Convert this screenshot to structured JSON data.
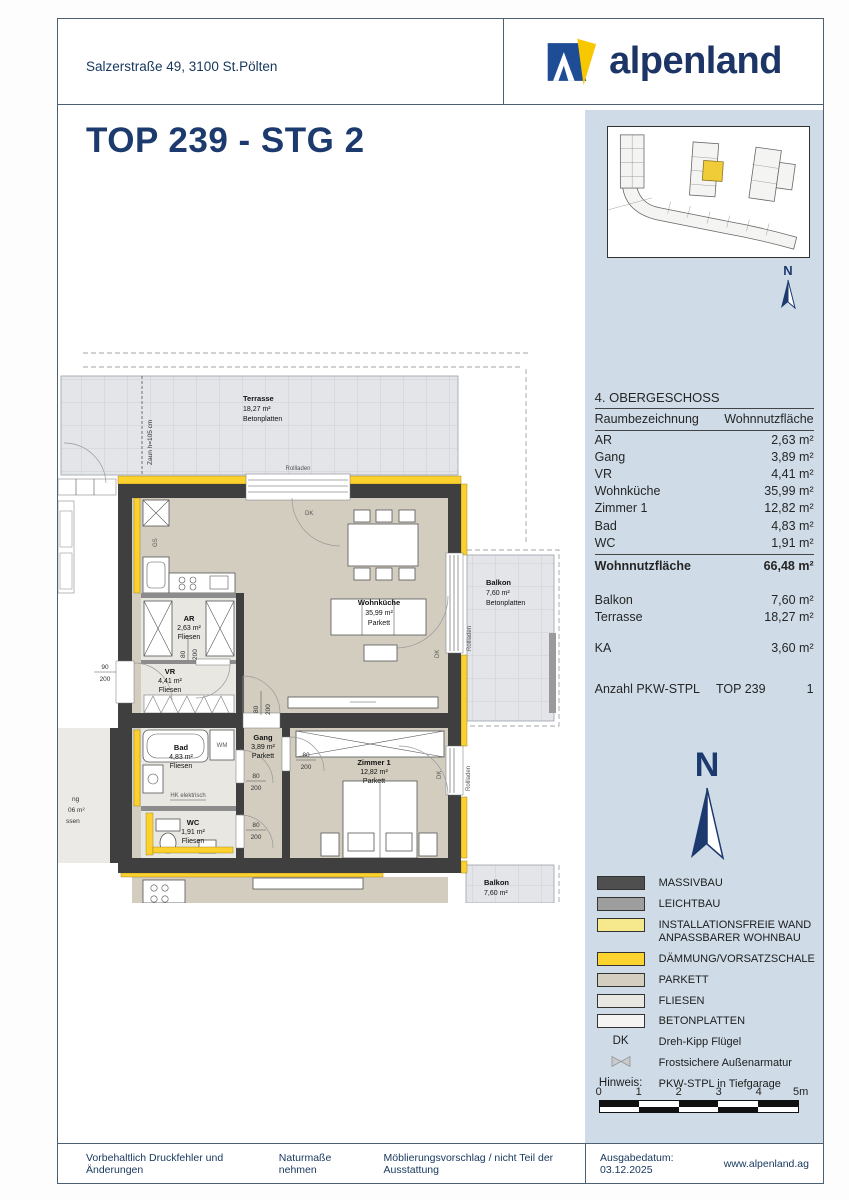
{
  "header": {
    "address": "Salzerstraße 49, 3100 St.Pölten",
    "brand": "alpenland"
  },
  "title": "TOP 239 - STG 2",
  "sidebar": {
    "floor_heading": "4. OBERGESCHOSS",
    "columns": {
      "room": "Raumbezeichnung",
      "area": "Wohnnutzfläche"
    },
    "rows": [
      {
        "label": "AR",
        "value": "2,63 m²"
      },
      {
        "label": "Gang",
        "value": "3,89 m²"
      },
      {
        "label": "VR",
        "value": "4,41 m²"
      },
      {
        "label": "Wohnküche",
        "value": "35,99 m²"
      },
      {
        "label": "Zimmer 1",
        "value": "12,82 m²"
      },
      {
        "label": "Bad",
        "value": "4,83 m²"
      },
      {
        "label": "WC",
        "value": "1,91 m²"
      }
    ],
    "total": {
      "label": "Wohnnutzfläche",
      "value": "66,48 m²"
    },
    "outdoor": [
      {
        "label": "Balkon",
        "value": "7,60 m²"
      },
      {
        "label": "Terrasse",
        "value": "18,27 m²"
      }
    ],
    "ka": {
      "label": "KA",
      "value": "3,60 m²"
    },
    "parking": {
      "label": "Anzahl PKW-STPL",
      "top": "TOP 239",
      "value": "1"
    },
    "north_label": "N"
  },
  "legend": {
    "items": [
      {
        "label": "MASSIVBAU",
        "label2": "",
        "color": "#4f4f4f"
      },
      {
        "label": "LEICHTBAU",
        "label2": "",
        "color": "#9e9e9e"
      },
      {
        "label": "INSTALLATIONSFREIE WAND",
        "label2": "ANPASSBARER WOHNBAU",
        "color": "#f6e88d"
      },
      {
        "label": "DÄMMUNG/VORSATZSCHALE",
        "label2": "",
        "color": "#fdd32f"
      },
      {
        "label": "PARKETT",
        "label2": "",
        "color": "#d4cec1"
      },
      {
        "label": "FLIESEN",
        "label2": "",
        "color": "#e9e7e2"
      },
      {
        "label": "BETONPLATTEN",
        "label2": "",
        "color": "#f5f4f2"
      }
    ],
    "dk_abbr": "DK",
    "dk_text": "Dreh-Kipp Flügel",
    "valve_text": "Frostsichere Außenarmatur",
    "hinweis_label": "Hinweis:",
    "hinweis_text": "PKW-STPL in Tiefgarage",
    "scale_labels": [
      "0",
      "1",
      "2",
      "3",
      "4",
      "5m"
    ]
  },
  "floorplan": {
    "rooms": [
      {
        "name": "Terrasse",
        "area": "18,27 m²",
        "floor": "Betonplatten"
      },
      {
        "name": "AR",
        "area": "2,63 m²",
        "floor": "Fliesen"
      },
      {
        "name": "VR",
        "area": "4,41 m²",
        "floor": "Fliesen"
      },
      {
        "name": "Wohnküche",
        "area": "35,99 m²",
        "floor": "Parkett"
      },
      {
        "name": "Gang",
        "area": "3,89 m²",
        "floor": "Parkett"
      },
      {
        "name": "Bad",
        "area": "4,83 m²",
        "floor": "Fliesen"
      },
      {
        "name": "WC",
        "area": "1,91 m²",
        "floor": "Fliesen"
      },
      {
        "name": "Zimmer 1",
        "area": "12,82 m²",
        "floor": "Parkett"
      },
      {
        "name": "Balkon",
        "area": "7,60 m²",
        "floor": "Betonplatten"
      },
      {
        "name": "Balkon",
        "area": "7,60 m²",
        "floor": ""
      }
    ],
    "ann": {
      "zaun": "Zaun h=105 cm",
      "rollladen": "Rollladen",
      "dk": "DK",
      "d80": "80",
      "d90": "90",
      "d200": "200",
      "hk": "HK elektrisch",
      "wm": "WM",
      "gs": "GS",
      "cut1": "ng",
      "cut2": "06 m²",
      "cut3": "ssen"
    }
  },
  "footer": {
    "disclaimer": "Vorbehaltlich Druckfehler und Änderungen",
    "note1": "Naturmaße nehmen",
    "note2": "Möblierungsvorschlag / nicht Teil der Ausstattung",
    "date_label": "Ausgabedatum:",
    "date": "03.12.2025",
    "website": "www.alpenland.ag"
  }
}
